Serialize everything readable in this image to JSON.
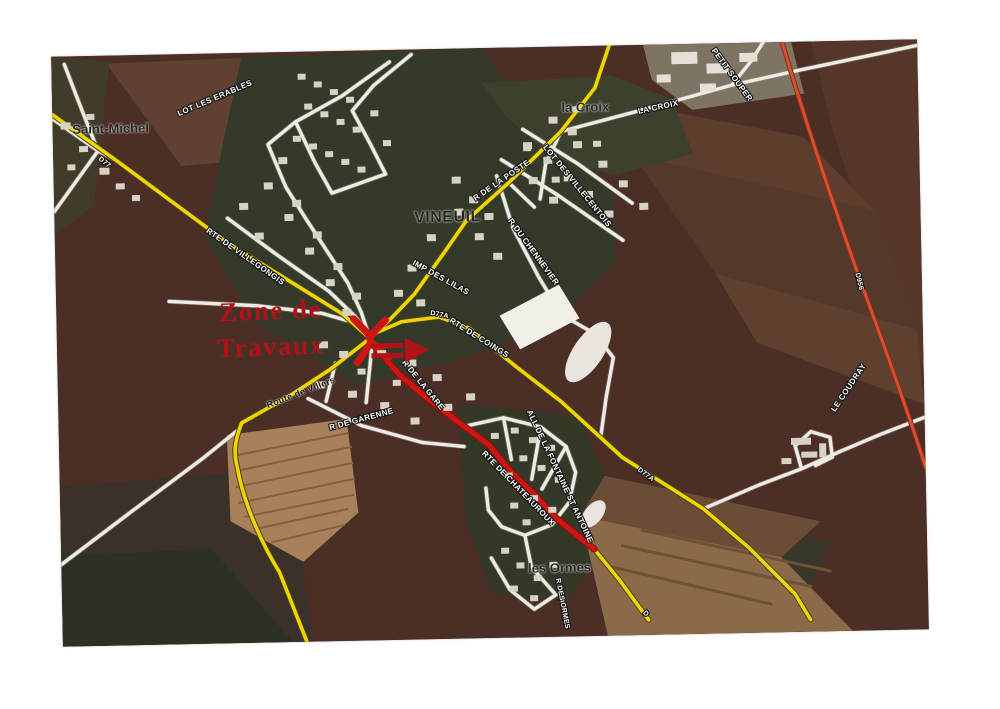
{
  "map": {
    "description": "Scanned aerial road map of Vineuil with highlighted roadworks zone",
    "colors": {
      "road_yellow": "#efd500",
      "road_white": "#efece4",
      "road_red_works": "#cf1512",
      "road_red_major": "#d4502f",
      "annotation_red": "#b01218",
      "field_dark": "#4b2e26",
      "village_green": "#333a29"
    },
    "places": {
      "saint_michel": "Saint-Michel",
      "vineuil": "VINEUIL",
      "la_croix": "la Croix",
      "les_ormes": "les Ormes"
    },
    "road_labels": {
      "lot_les_erables": "LOT LES ERABLES",
      "r_de_la_poste": "R DE LA POSTE",
      "la_croix": "LA CROIX",
      "petit_souper": "PETIT SOUPER",
      "lot_des_villecentois": "LOT DES VILLECENTOIS",
      "r_du_chennevier": "R DU CHENNEVIER",
      "rte_de_villegongis": "RTE DE VILLEGONGIS",
      "imp_des_lilas": "IMP DES LILAS",
      "d77a_center": "D77A",
      "rte_de_coings": "RTE DE COINGS",
      "route_de_villers": "Route de Villers",
      "r_de_garenne": "R DE GARENNE",
      "r_de_la_gare": "R DE LA GARE",
      "rte_de_chateauroux": "RTE DE CHATEAUROUX",
      "all_fontaine_st_antoine": "ALL DE LA FONTAINE ST ANTOINE",
      "r_des_ormes": "R DES ORMES",
      "le_coudray": "LE COUDRAY",
      "d956": "D956",
      "d77a_east": "D77A",
      "d_north": "D77",
      "d_south": "D"
    },
    "annotation": {
      "line1": "Zone de",
      "line2": "Travaux",
      "arrow_icon": "double-arrow-right"
    }
  }
}
